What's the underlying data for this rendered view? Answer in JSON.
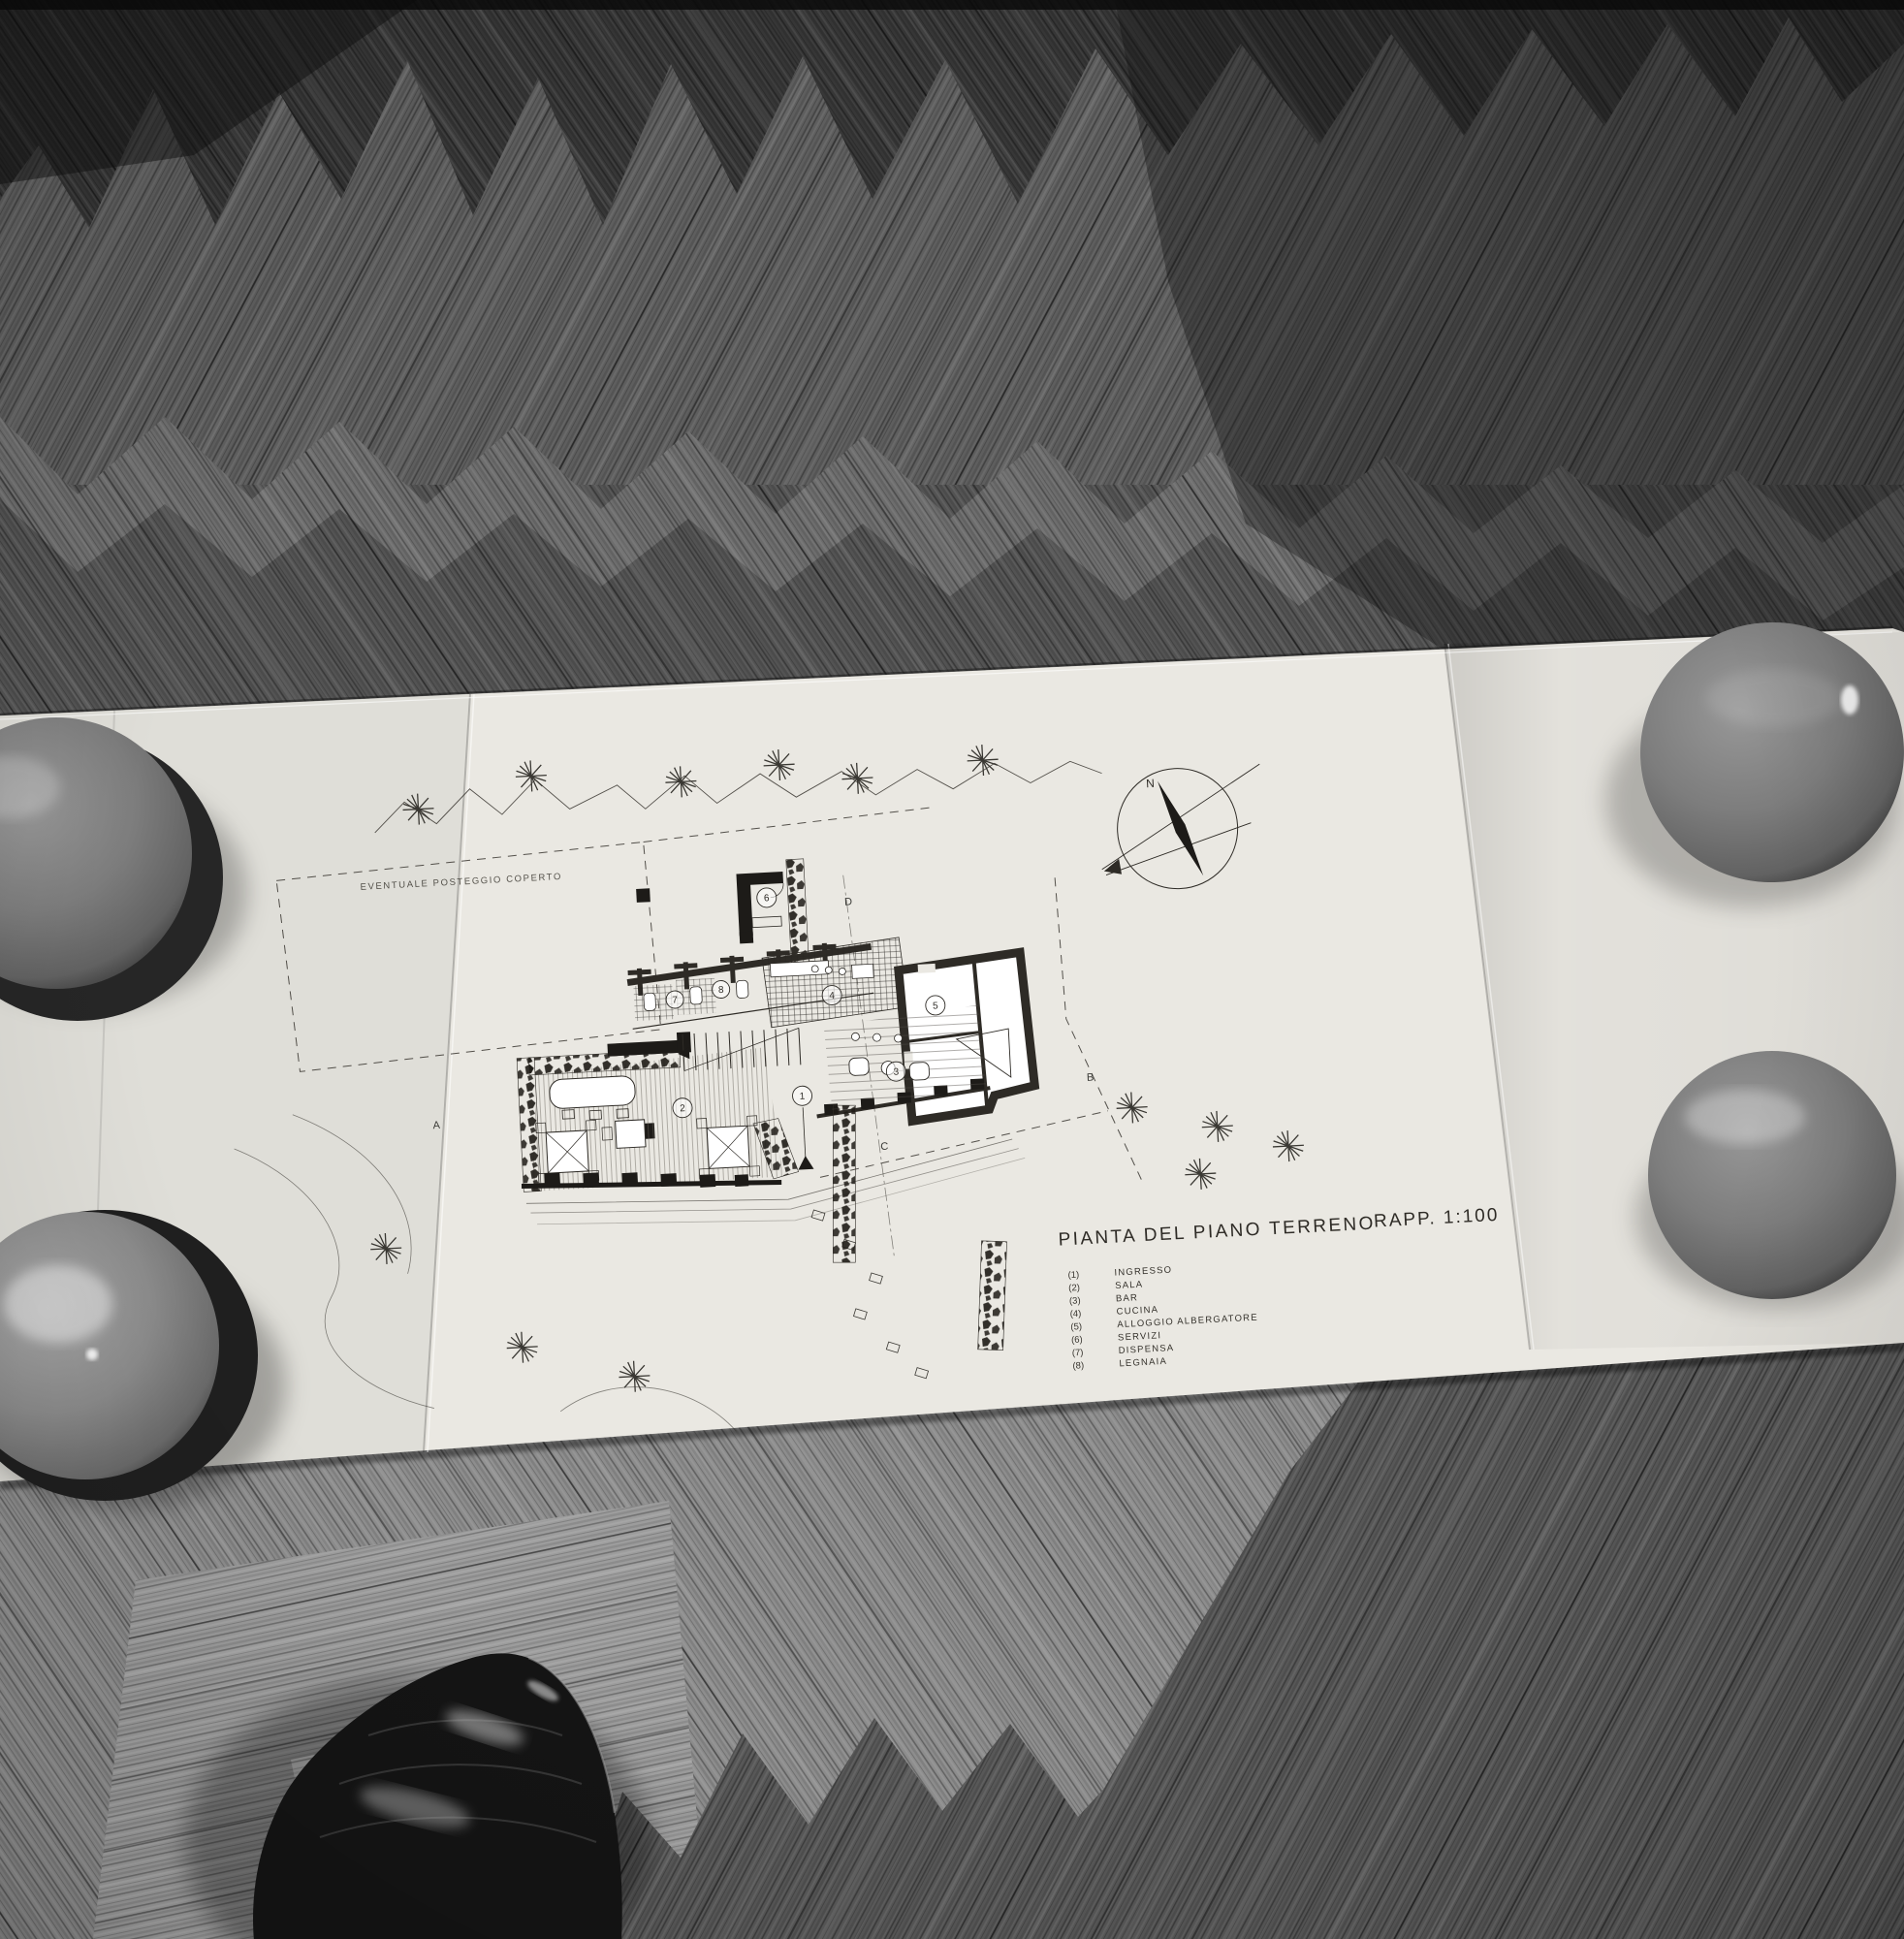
{
  "drawing": {
    "title": "PIANTA DEL PIANO TERRENO",
    "scale": "RAPP. 1:100",
    "site_note": "EVENTUALE POSTEGGIO COPERTO",
    "north": "N",
    "sections": {
      "a": "A",
      "b": "B",
      "c": "C",
      "d": "D"
    },
    "legend": [
      {
        "num": "(1)",
        "label": "INGRESSO"
      },
      {
        "num": "(2)",
        "label": "SALA"
      },
      {
        "num": "(3)",
        "label": "BAR"
      },
      {
        "num": "(4)",
        "label": "CUCINA"
      },
      {
        "num": "(5)",
        "label": "ALLOGGIO ALBERGATORE"
      },
      {
        "num": "(6)",
        "label": "SERVIZI"
      },
      {
        "num": "(7)",
        "label": "DISPENSA"
      },
      {
        "num": "(8)",
        "label": "LEGNAIA"
      }
    ],
    "rooms": [
      {
        "n": "1"
      },
      {
        "n": "2"
      },
      {
        "n": "3"
      },
      {
        "n": "4"
      },
      {
        "n": "5"
      },
      {
        "n": "6"
      },
      {
        "n": "7"
      },
      {
        "n": "8"
      }
    ]
  },
  "colors": {
    "paper": "#eae8e2",
    "ink": "#2e2b26",
    "wood_dark": "#373737",
    "wood_mid": "#5e5e5e",
    "wood_light": "#8d8d8d",
    "bowl_gray": "#888888",
    "shoe_black": "#141414"
  }
}
